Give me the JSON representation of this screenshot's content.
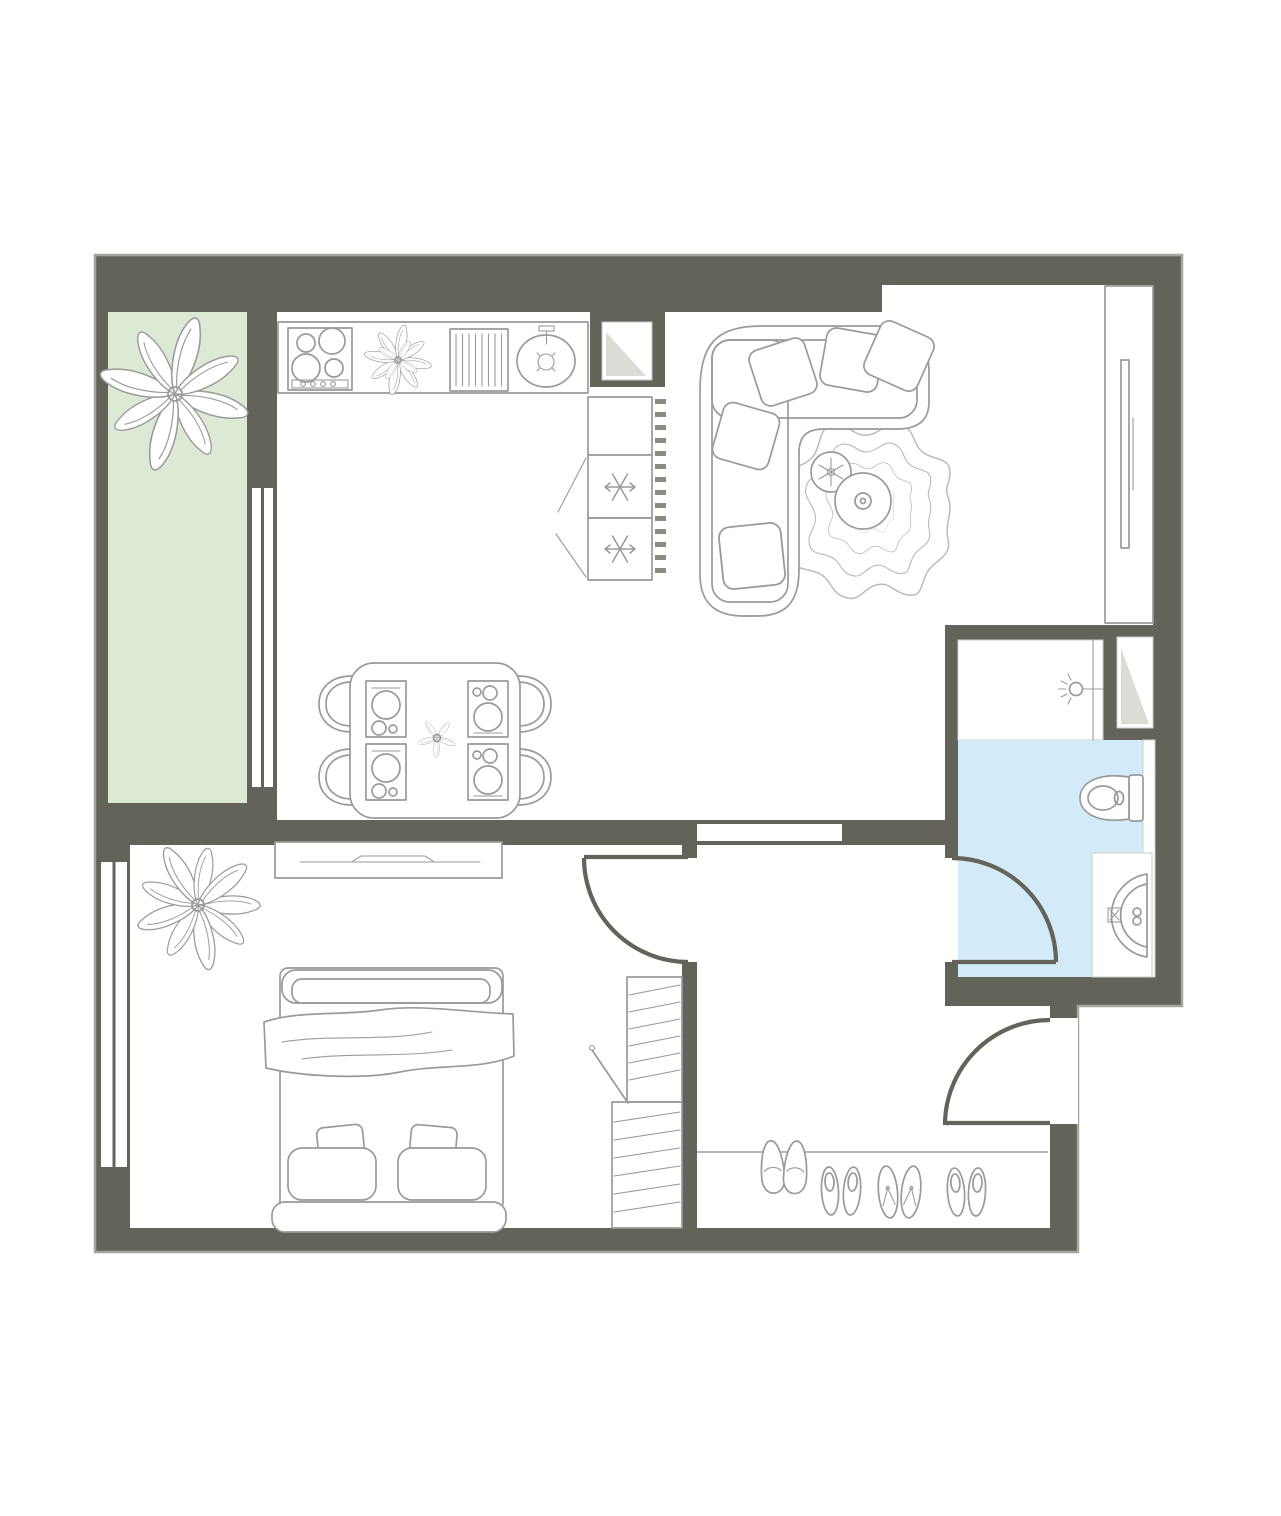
{
  "page": {
    "type": "architectural-floor-plan",
    "background": "#ffffff",
    "visible_text": []
  },
  "colors": {
    "wall": "#63635A",
    "outline": "#A5A59D",
    "floor": "#FFFFFF",
    "balcony_floor": "#DBE9D5",
    "bathroom_floor": "#D3EAF8",
    "furniture_stroke": "#9A9A9A",
    "rug_stroke": "#BBBBB8",
    "fold_gray": "#DCDCD7",
    "vent_dash": "#8B8B82"
  },
  "rooms": [
    {
      "name": "balcony",
      "floor_color_key": "balcony_floor",
      "items": [
        "large-plant"
      ]
    },
    {
      "name": "kitchen",
      "floor_color_key": "floor",
      "items": [
        "counter",
        "stove-4-burners",
        "counter-plant",
        "dish-rack",
        "sink-with-faucet",
        "ventilation-shaft",
        "fridge-with-2-freezer-drawers",
        "radiator-dash-strip"
      ]
    },
    {
      "name": "living-room",
      "floor_color_key": "floor",
      "items": [
        "corner-sofa",
        "sofa-pillows",
        "wavy-rug",
        "coffee-table",
        "potted-plant",
        "tv-wall-unit",
        "wall-mounted-tv"
      ]
    },
    {
      "name": "dining-area",
      "floor_color_key": "floor",
      "items": [
        "square-table",
        "4-chairs",
        "4-place-settings",
        "center-flower"
      ]
    },
    {
      "name": "bedroom",
      "floor_color_key": "floor",
      "items": [
        "double-bed",
        "blanket",
        "2-pillows",
        "2-cushions",
        "headboard",
        "dresser",
        "wardrobe-with-hanging-clothes",
        "floor-plant",
        "window"
      ]
    },
    {
      "name": "hallway",
      "floor_color_key": "floor",
      "items": [
        "entry-mat-line",
        "shoe-row"
      ]
    },
    {
      "name": "bathroom",
      "floor_color_key": "bathroom_floor",
      "items": [
        "toilet",
        "wash-basin",
        "light-point",
        "ventilation-niche",
        "plumbing-strip"
      ]
    }
  ],
  "openings": {
    "windows": 2,
    "interior_doors": 3,
    "entry_doors": 1,
    "cased_passages": 1
  },
  "counts": {
    "stove_burners": 4,
    "freezer_drawers": 2,
    "dining_chairs": 4,
    "place_settings": 4,
    "sofa_pillows": 5,
    "bed_pillows": 2,
    "bed_cushions": 2,
    "shoe_pairs": 4,
    "plants": 5
  },
  "icons": {
    "snowflake-icon": "freezer compartment",
    "lamp-icon": "light / water point",
    "fold-icon": "ventilation shaft",
    "shoe-icons": "footwear at entry",
    "plant-icon": "house plant"
  }
}
